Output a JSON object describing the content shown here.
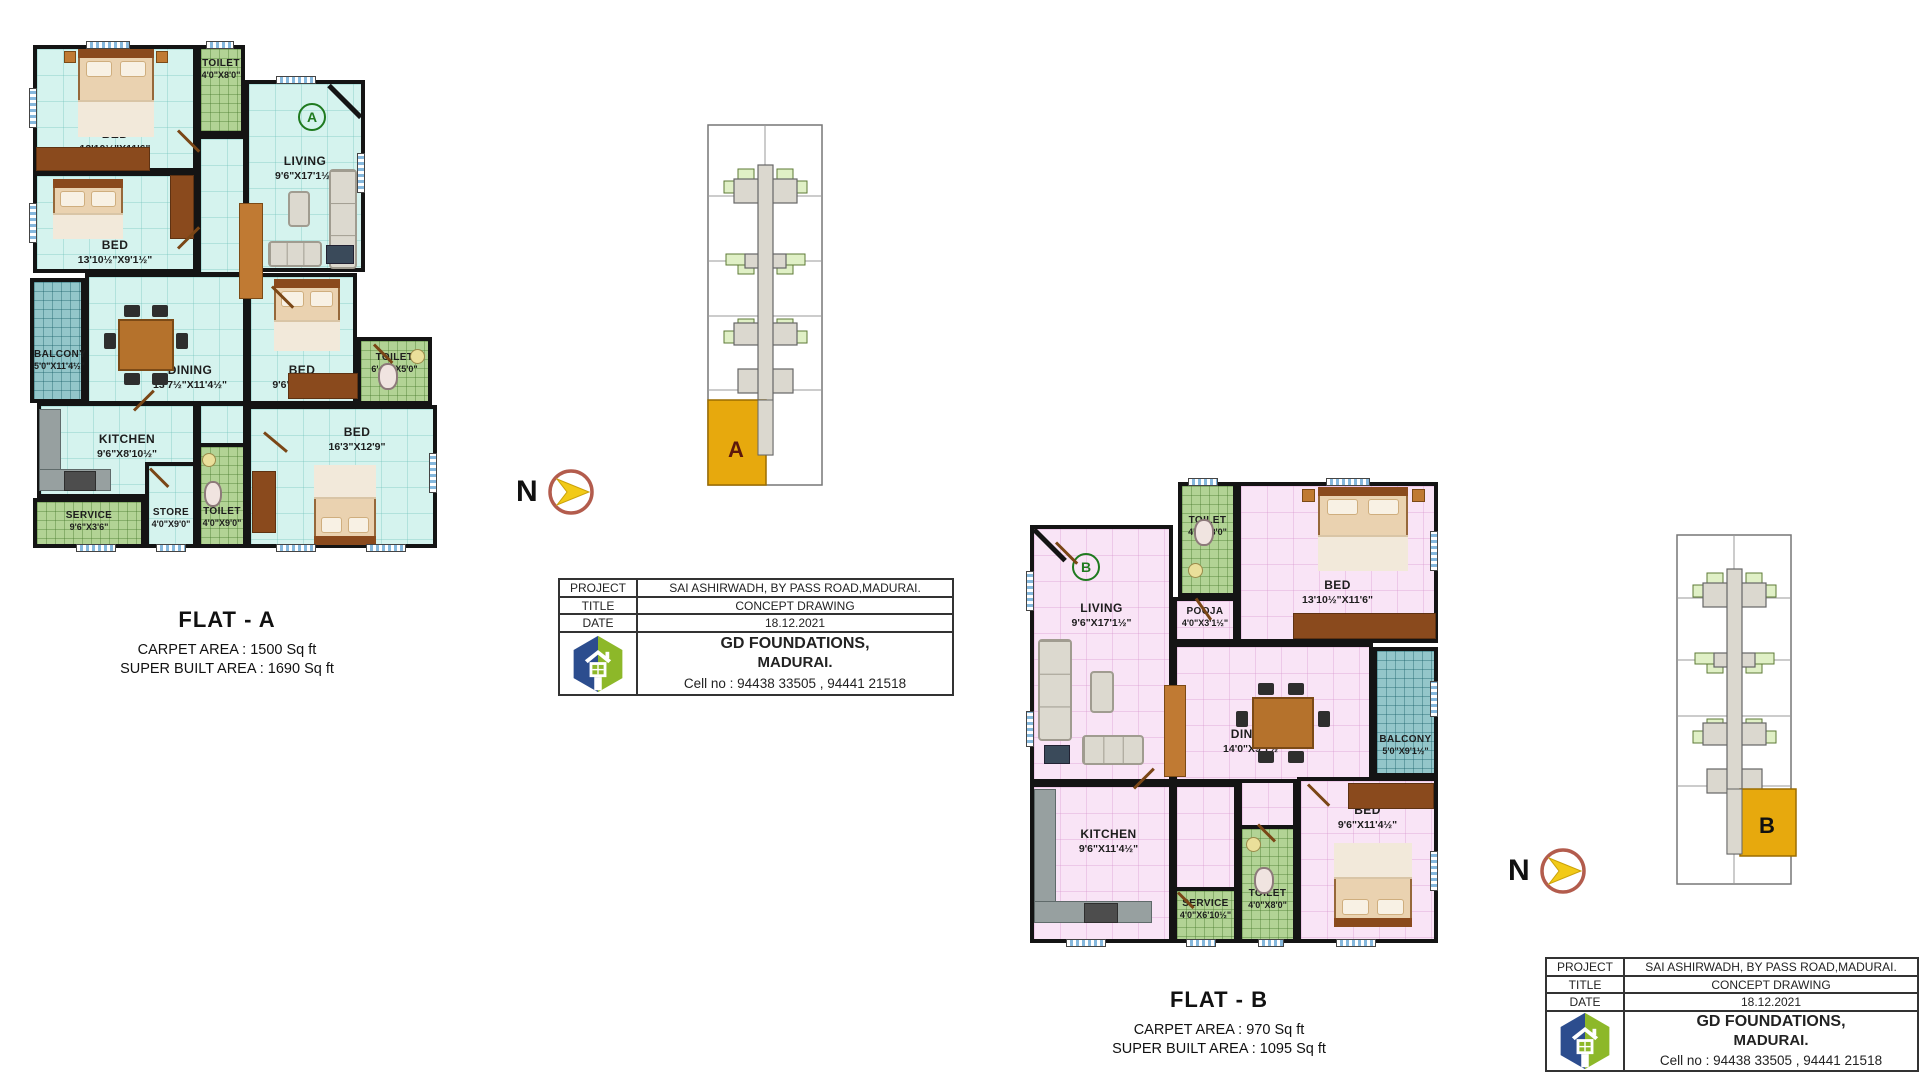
{
  "colors": {
    "wall": "#141414",
    "floor_a": "#d5f3ee",
    "floor_b": "#f9e4f6",
    "tile_green": "#b2d395",
    "tile_teal": "#93c6ca",
    "wood": "#8a4a1d",
    "wood_light": "#c07a33",
    "counter": "#97a0a0",
    "keyplan_unit": "#e7a90d",
    "keyplan_green": "#e0f0c6",
    "corridor": "#dbd8cf",
    "logo_blue": "#2c4d8e",
    "logo_green": "#8db829",
    "north_ring": "#b35c4d",
    "north_arrow": "#f2ca17",
    "marker": "#1f7a1f"
  },
  "north": {
    "label": "N"
  },
  "flat_a": {
    "marker": "A",
    "title": "FLAT - A",
    "carpet": "CARPET AREA  :  1500 Sq ft",
    "super_built": "SUPER BUILT AREA  :  1690 Sq ft",
    "rooms": [
      {
        "name": "BED",
        "dim": "13'10½\"X11'6\""
      },
      {
        "name": "TOILET",
        "dim": "4'0\"X8'0\""
      },
      {
        "name": "LIVING",
        "dim": "9'6\"X17'1½\""
      },
      {
        "name": "BED",
        "dim": "13'10½\"X9'1½\""
      },
      {
        "name": "BALCONY",
        "dim": "5'0\"X11'4½\""
      },
      {
        "name": "DINING",
        "dim": "13'7½\"X11'4½\""
      },
      {
        "name": "BED",
        "dim": "9'6\"X11'4½\""
      },
      {
        "name": "TOILET",
        "dim": "6'4½\"X5'0\""
      },
      {
        "name": "KITCHEN",
        "dim": "9'6\"X8'10½\""
      },
      {
        "name": "STORE",
        "dim": "4'0\"X9'0\""
      },
      {
        "name": "TOILET",
        "dim": "4'0\"X9'0\""
      },
      {
        "name": "SERVICE",
        "dim": "9'6\"X3'6\""
      },
      {
        "name": "BED",
        "dim": "16'3\"X12'9\""
      }
    ]
  },
  "flat_b": {
    "marker": "B",
    "title": "FLAT - B",
    "carpet": "CARPET AREA  :  970 Sq ft",
    "super_built": "SUPER BUILT AREA  :  1095 Sq ft",
    "rooms": [
      {
        "name": "TOILET",
        "dim": "4'0\"X8'0\""
      },
      {
        "name": "BED",
        "dim": "13'10½\"X11'6\""
      },
      {
        "name": "LIVING",
        "dim": "9'6\"X17'1½\""
      },
      {
        "name": "POOJA",
        "dim": "4'0\"X3'1½\""
      },
      {
        "name": "BALCONY",
        "dim": "5'0\"X9'1½\""
      },
      {
        "name": "DINING",
        "dim": "14'0\"X9'1½\""
      },
      {
        "name": "KITCHEN",
        "dim": "9'6\"X11'4½\""
      },
      {
        "name": "SERVICE",
        "dim": "4'0\"X6'10½\""
      },
      {
        "name": "TOILET",
        "dim": "4'0\"X8'0\""
      },
      {
        "name": "BED",
        "dim": "9'6\"X11'4½\""
      }
    ]
  },
  "key_plan_a": {
    "unit_label": "A"
  },
  "key_plan_b": {
    "unit_label": "B"
  },
  "title_block": {
    "rows": [
      {
        "label": "PROJECT",
        "value": "SAI ASHIRWADH, BY PASS ROAD,MADURAI."
      },
      {
        "label": "TITLE",
        "value": "CONCEPT DRAWING"
      },
      {
        "label": "DATE",
        "value": "18.12.2021"
      }
    ],
    "company_line1": "GD FOUNDATIONS,",
    "company_line2": "MADURAI.",
    "company_line3": "Cell no : 94438 33505 , 94441 21518"
  }
}
